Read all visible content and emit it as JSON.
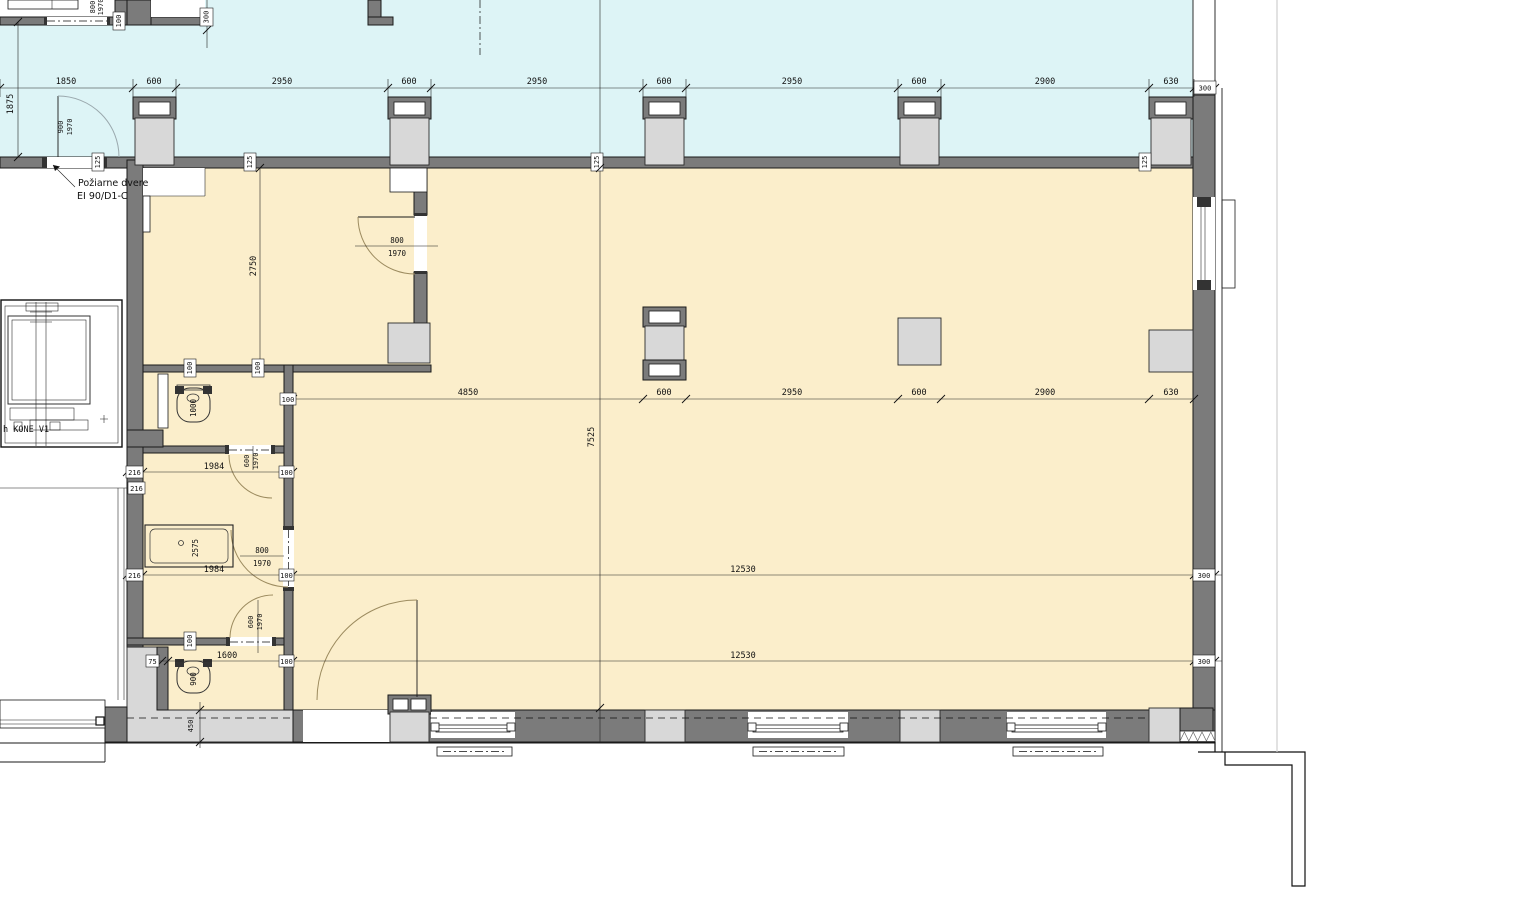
{
  "dims": {
    "top": [
      "1850",
      "600",
      "2950",
      "600",
      "2950",
      "600",
      "2950",
      "600",
      "2900",
      "630"
    ],
    "top_box": "300",
    "mid_box": "100",
    "mid": [
      "4850",
      "600",
      "2950",
      "600",
      "2900",
      "630"
    ],
    "wc_top": [
      "216",
      "1984",
      "100"
    ],
    "wc_top_extra": "216",
    "line_mid": [
      "216",
      "1984",
      "100",
      "12530",
      "300"
    ],
    "line_bottom": [
      "75",
      "1600",
      "100",
      "12530",
      "300"
    ],
    "corridor_height": "1875",
    "vestibule_depth": "2750",
    "hall_depth": "7525",
    "plinth": "450",
    "grid_300": "300",
    "topleft_100": "100",
    "wall_125": [
      "125",
      "125",
      "125",
      "125"
    ],
    "wall_100": [
      "100",
      "100",
      "100"
    ]
  },
  "doors": {
    "fire": {
      "width": "900",
      "height": "1970"
    },
    "top_left": {
      "width": "800",
      "height": "1970"
    },
    "vestibule": {
      "width": "800",
      "height": "1970"
    },
    "wc1": {
      "width": "600",
      "height": "1970"
    },
    "washroom": {
      "width": "800",
      "height": "1970"
    },
    "wc2": {
      "width": "600",
      "height": "1970"
    }
  },
  "notes": {
    "fire_door_label_1": "Požiarne dvere",
    "fire_door_label_2": "EI 90/D1-C",
    "elevator_label": "h KONE V1"
  },
  "fixtures": {
    "wc1_toilet": "1000",
    "washbasin": "2575",
    "wc2_toilet": "900"
  },
  "colors": {
    "corridor_fill": "#ddf4f6",
    "hall_fill": "#fbeecb",
    "wall_fill": "#7b7b7b",
    "column_fill": "#d8d8d8",
    "door_arc": "#9c8b5f"
  }
}
